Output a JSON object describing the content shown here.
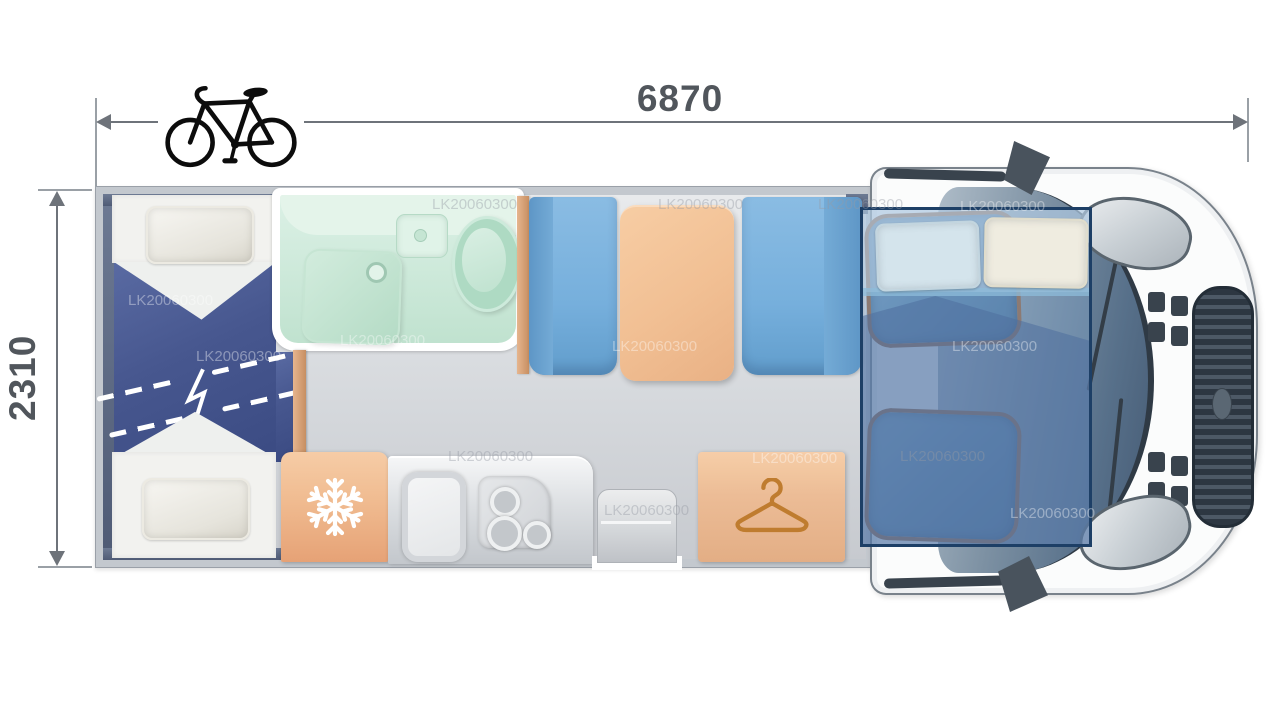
{
  "diagram": {
    "type": "motorhome-floorplan-top-view",
    "length_label": "6870",
    "width_label": "2310",
    "watermark_text": "LK20060300"
  },
  "icons": {
    "roof_rack": "bicycle-icon",
    "fridge": "snowflake-icon",
    "wardrobe": "clothes-hanger-icon"
  },
  "palette": {
    "dimension_text": "#51565c",
    "dimension_line": "#6e737a",
    "wall_gray": "#c3c8ce",
    "wall_dark_slate": "#5d6b85",
    "floor_gray": "#dfe2e5",
    "bed_blanket_blue": "#47578f",
    "mattress_white": "#f2f2ef",
    "bathroom_mint": "#cbe8d8",
    "bench_blue": "#76afdc",
    "table_peach": "#f1bf93",
    "fridge_peach": "#f0bb90",
    "wardrobe_peach": "#ecbc96",
    "hanger_brown": "#bf7c2f",
    "wood_partition": "#d2996c",
    "overcab_bed_border": "#1d3f66",
    "overcab_bed_fill": "#2f4d82",
    "cab_seat_outline": "#93603c",
    "vehicle_dark": "#39434d"
  }
}
